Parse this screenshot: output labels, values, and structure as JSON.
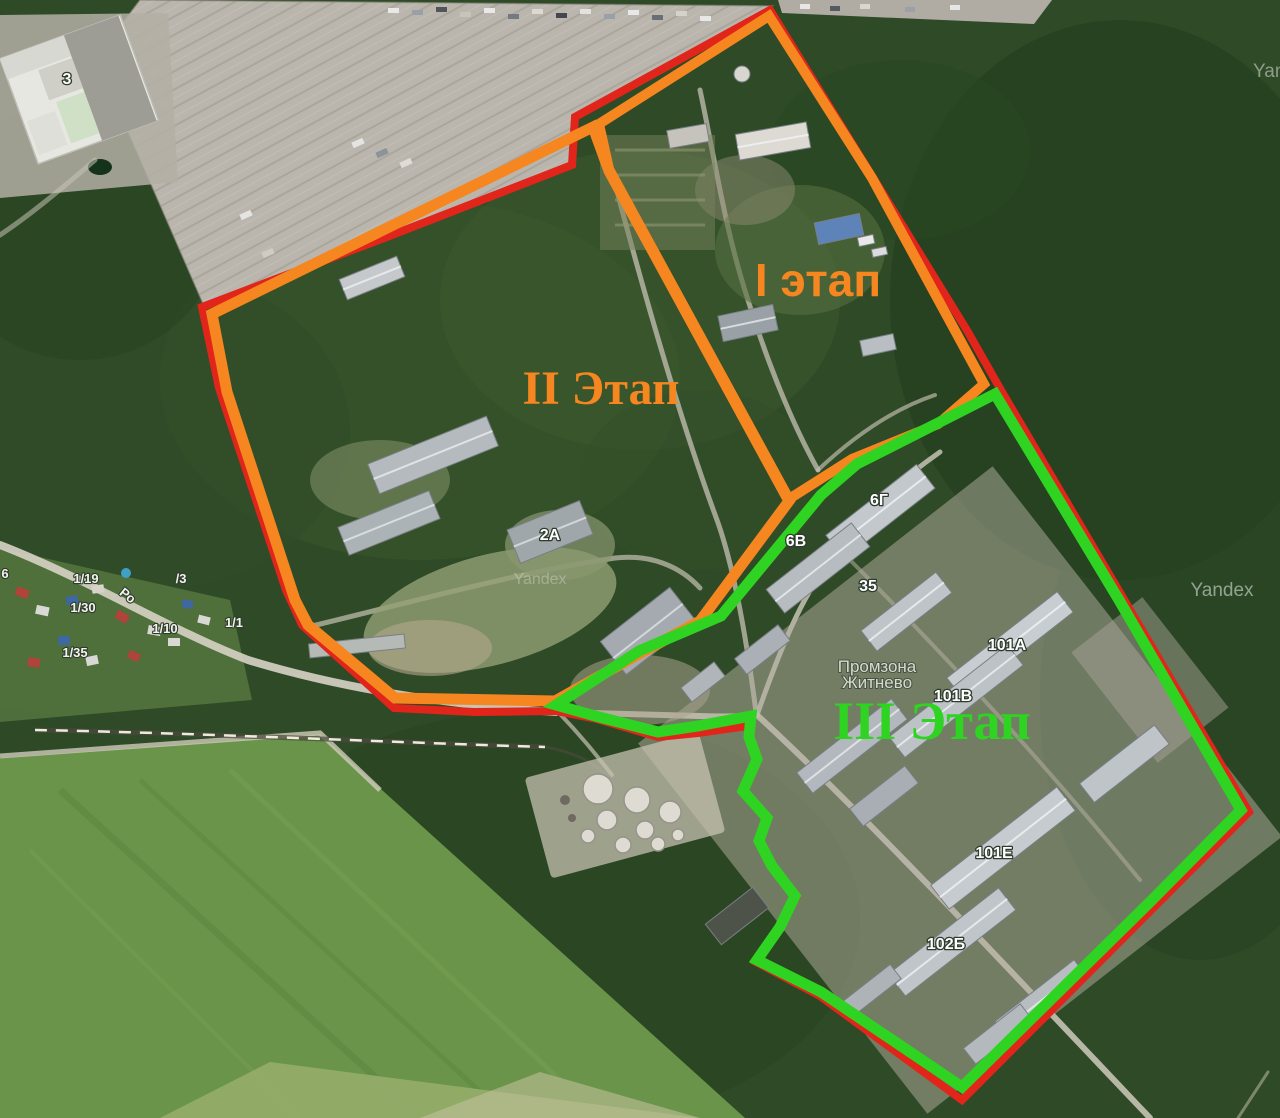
{
  "colors": {
    "boundary_red": "#e1251b",
    "phase_orange": "#f6861f",
    "phase_green": "#2fd321"
  },
  "site_boundary": {
    "color": "#e1251b",
    "stroke_width": 8,
    "points": [
      [
        770,
        10
      ],
      [
        968,
        332
      ],
      [
        1002,
        392
      ],
      [
        1249,
        812
      ],
      [
        962,
        1100
      ],
      [
        820,
        996
      ],
      [
        756,
        962
      ],
      [
        780,
        929
      ],
      [
        796,
        898
      ],
      [
        773,
        867
      ],
      [
        760,
        842
      ],
      [
        768,
        818
      ],
      [
        744,
        792
      ],
      [
        758,
        760
      ],
      [
        750,
        738
      ],
      [
        747,
        726
      ],
      [
        698,
        733
      ],
      [
        658,
        737
      ],
      [
        597,
        719
      ],
      [
        556,
        711
      ],
      [
        474,
        712
      ],
      [
        394,
        708
      ],
      [
        302,
        625
      ],
      [
        286,
        590
      ],
      [
        219,
        388
      ],
      [
        202,
        307
      ],
      [
        392,
        235
      ],
      [
        572,
        165
      ],
      [
        575,
        117
      ]
    ]
  },
  "phases": [
    {
      "id": "phase-1",
      "label": "I этап",
      "color": "#f6861f",
      "stroke_width": 10,
      "label_x": 818,
      "label_y": 296,
      "label_size": 46,
      "label_font": "sans",
      "points": [
        [
          599,
          124
        ],
        [
          769,
          16
        ],
        [
          872,
          178
        ],
        [
          984,
          384
        ],
        [
          938,
          424
        ],
        [
          852,
          459
        ],
        [
          789,
          499
        ],
        [
          609,
          169
        ]
      ]
    },
    {
      "id": "phase-2",
      "label": "II Этап",
      "color": "#f6861f",
      "stroke_width": 11,
      "label_x": 601,
      "label_y": 404,
      "label_size": 48,
      "label_font": "serif",
      "points": [
        [
          593,
          127
        ],
        [
          212,
          314
        ],
        [
          227,
          392
        ],
        [
          295,
          600
        ],
        [
          308,
          625
        ],
        [
          395,
          698
        ],
        [
          555,
          701
        ],
        [
          639,
          654
        ],
        [
          700,
          621
        ],
        [
          789,
          501
        ],
        [
          609,
          171
        ]
      ]
    },
    {
      "id": "phase-3",
      "label": "III Этап",
      "color": "#2fd321",
      "stroke_width": 11,
      "label_x": 932,
      "label_y": 739,
      "label_size": 54,
      "label_font": "serif",
      "points": [
        [
          995,
          394
        ],
        [
          1119,
          600
        ],
        [
          1241,
          810
        ],
        [
          1152,
          900
        ],
        [
          962,
          1087
        ],
        [
          821,
          992
        ],
        [
          757,
          960
        ],
        [
          780,
          927
        ],
        [
          795,
          896
        ],
        [
          772,
          866
        ],
        [
          759,
          841
        ],
        [
          767,
          818
        ],
        [
          743,
          791
        ],
        [
          757,
          759
        ],
        [
          749,
          737
        ],
        [
          751,
          716
        ],
        [
          698,
          726
        ],
        [
          658,
          732
        ],
        [
          599,
          717
        ],
        [
          556,
          705
        ],
        [
          639,
          651
        ],
        [
          721,
          616
        ],
        [
          821,
          495
        ],
        [
          857,
          464
        ],
        [
          938,
          423
        ]
      ]
    }
  ],
  "map": {
    "building_labels": [
      {
        "text": "3",
        "x": 67,
        "y": 84
      },
      {
        "text": "2А",
        "x": 550,
        "y": 540
      },
      {
        "text": "6Г",
        "x": 879,
        "y": 505
      },
      {
        "text": "6В",
        "x": 796,
        "y": 546
      },
      {
        "text": "35",
        "x": 868,
        "y": 591
      },
      {
        "text": "101А",
        "x": 1007,
        "y": 650
      },
      {
        "text": "101В",
        "x": 953,
        "y": 701
      },
      {
        "text": "101Е",
        "x": 994,
        "y": 858
      },
      {
        "text": "102Б",
        "x": 946,
        "y": 949
      }
    ],
    "parcel_labels": [
      {
        "text": "6",
        "x": 5,
        "y": 578
      },
      {
        "text": "1/19",
        "x": 86,
        "y": 583
      },
      {
        "text": "/3",
        "x": 181,
        "y": 583
      },
      {
        "text": "1/30",
        "x": 83,
        "y": 612
      },
      {
        "text": "1/10",
        "x": 165,
        "y": 633
      },
      {
        "text": "1/1",
        "x": 234,
        "y": 627
      },
      {
        "text": "1/35",
        "x": 75,
        "y": 657
      }
    ],
    "road_label": {
      "text": "Ро",
      "x": 125,
      "y": 599,
      "rotate": 38,
      "size": 14
    },
    "place_label": {
      "lines": [
        "Промзона",
        "Житнево"
      ],
      "x": 877,
      "y": 672,
      "line_height": 16
    },
    "watermarks": [
      {
        "text": "Yandex",
        "x": 1222,
        "y": 596,
        "size": 19,
        "opacity": 0.5,
        "anchor": "middle"
      },
      {
        "text": "Yandex",
        "x": 1253,
        "y": 77,
        "size": 19,
        "opacity": 0.45,
        "anchor": "start"
      },
      {
        "text": "Yandex",
        "x": 540,
        "y": 584,
        "size": 16,
        "opacity": 0.28,
        "anchor": "middle"
      }
    ]
  }
}
